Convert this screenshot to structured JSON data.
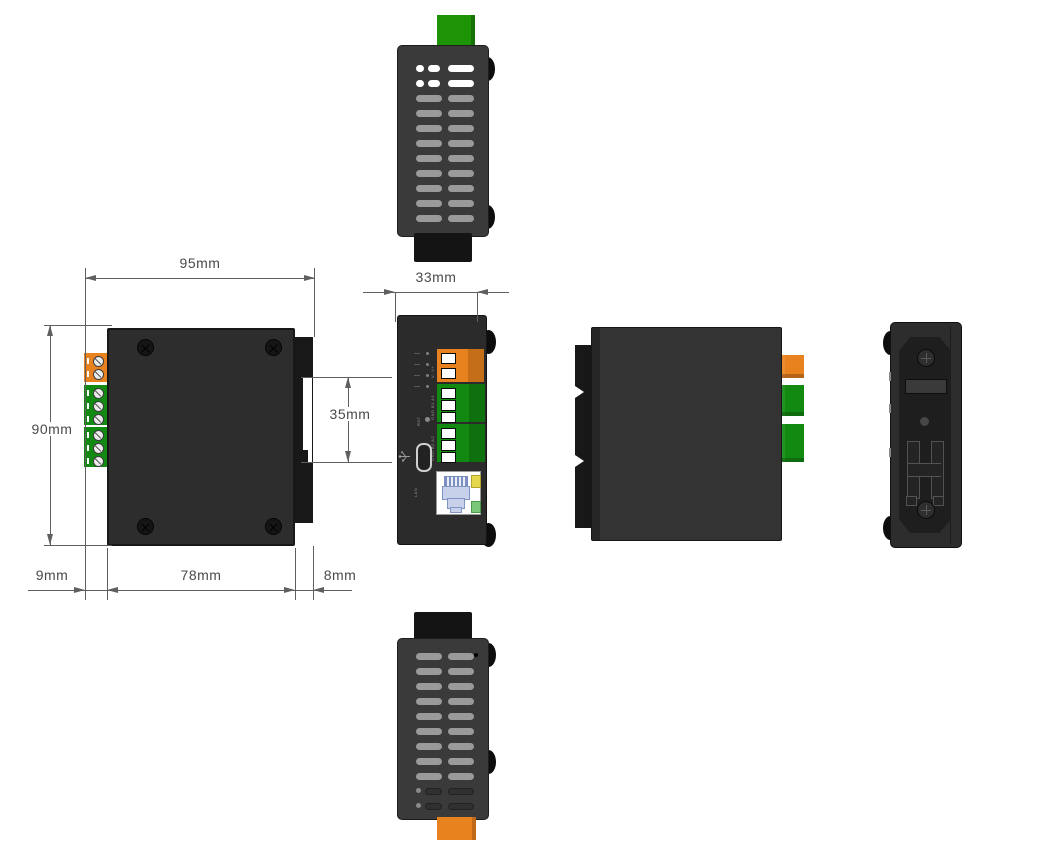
{
  "title": "Device mechanical dimension drawing",
  "units": "mm",
  "dims": {
    "overall_width": "95mm",
    "overall_height": "90mm",
    "left_terminal_depth": "9mm",
    "body_width": "78mm",
    "flange_depth": "8mm",
    "face_width": "33mm",
    "rail_slot_height": "35mm"
  },
  "views": {
    "top_view": {
      "label": "top view",
      "vent_rows": 11
    },
    "front_view": {
      "label": "front view",
      "power_cells": 2,
      "serial1_cells": 3,
      "serial2_cells": 3
    },
    "face_view": {
      "label": "face view",
      "led_count": 4,
      "power_squares": 2,
      "serial1_squares": 3,
      "serial2_squares": 3,
      "power_label": "V- V+",
      "serial1_label": "GND B1 A1",
      "serial2_label": "GND B2 A2",
      "reset_label": "RST",
      "lan_label": "LAN"
    },
    "side_view": {
      "label": "side view"
    },
    "rear_view": {
      "label": "rear view"
    },
    "bottom_view": {
      "label": "bottom view",
      "vent_rows": 11
    }
  },
  "colors": {
    "body": "#333333",
    "body-light": "#3a3a3a",
    "panel": "#2b2b2b",
    "dark": "#161616",
    "green": "#128a12",
    "green-bright": "#1d9306",
    "orange": "#e8821e",
    "vent": "#9a9a9a",
    "dim": "#5f5f5f",
    "txt": "#4a4a4a",
    "rj45-blue": "#c7d2ea"
  }
}
